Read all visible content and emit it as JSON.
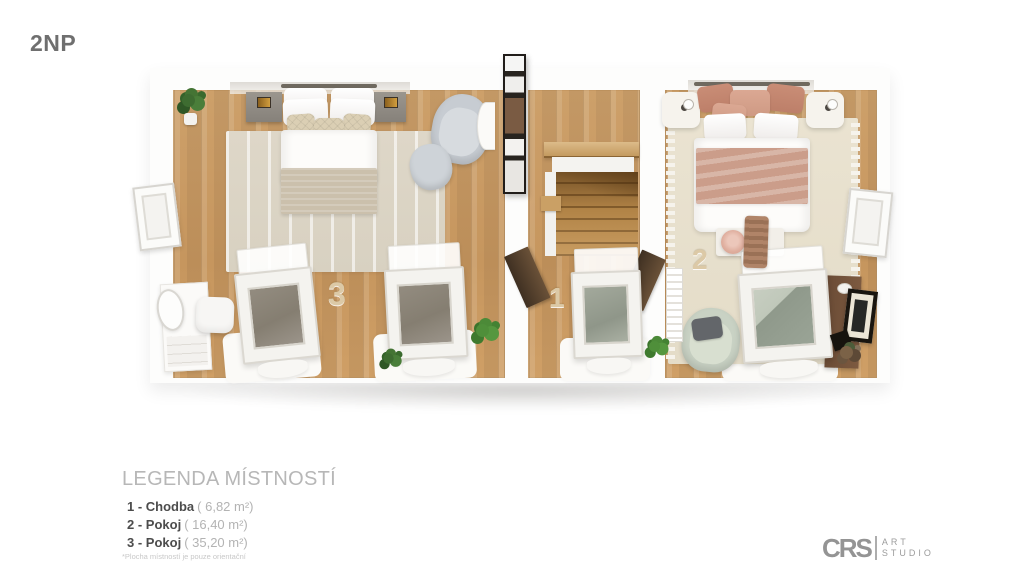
{
  "page": {
    "floor_label": "2NP"
  },
  "floorplan": {
    "labels": {
      "room1": "1",
      "room2": "2",
      "room3": "3"
    }
  },
  "legend": {
    "title": "LEGENDA MÍSTNOSTÍ",
    "items": [
      {
        "label": "1 - Chodba",
        "area": "( 6,82 m²)"
      },
      {
        "label": "2 - Pokoj",
        "area": "( 16,40 m²)"
      },
      {
        "label": "3 - Pokoj",
        "area": "( 35,20 m²)"
      }
    ],
    "footnote": "*Plocha místností je pouze orientační"
  },
  "logo": {
    "initials": "CRS",
    "name_line1": "ART",
    "name_line2": "STUDIO"
  },
  "colors": {
    "floor_wood": "#c99b63",
    "wall_white": "#fbfbfa",
    "room_number": "#dcc9a6",
    "title_gray": "#6f6f6f"
  }
}
